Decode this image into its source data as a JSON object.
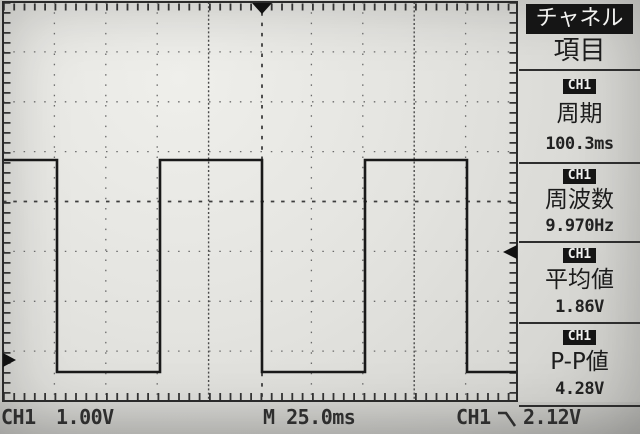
{
  "device": "oscilloscope-screen",
  "sidebar": {
    "title": "チャネル",
    "subtitle": "項目",
    "measurements": [
      {
        "channel": "CH1",
        "label": "周期",
        "value": "100.3ms"
      },
      {
        "channel": "CH1",
        "label": "周波数",
        "value": "9.970Hz"
      },
      {
        "channel": "CH1",
        "label": "平均値",
        "value": "1.86V"
      },
      {
        "channel": "CH1",
        "label": "P-P値",
        "value": "4.28V"
      }
    ]
  },
  "status_bar": {
    "ch1_label": "CH1",
    "ch1_scale": "1.00V",
    "timebase": "M 25.0ms",
    "trigger_source": "CH1",
    "trigger_edge_icon": "falling-edge-icon",
    "trigger_level": "2.12V"
  },
  "display": {
    "divisions": {
      "horizontal": 10,
      "vertical": 8
    },
    "waveform": {
      "channel": "CH1",
      "shape": "square",
      "volts_per_div": "1.00V",
      "time_per_div": "25.0ms",
      "period": "100.3ms",
      "frequency": "9.970Hz",
      "mean": "1.86V",
      "peak_to_peak": "4.28V",
      "points": [
        [
          4,
          160
        ],
        [
          57,
          160
        ],
        [
          57,
          372
        ],
        [
          160,
          372
        ],
        [
          160,
          160
        ],
        [
          262,
          160
        ],
        [
          262,
          372
        ],
        [
          365,
          372
        ],
        [
          365,
          160
        ],
        [
          467,
          160
        ],
        [
          467,
          372
        ],
        [
          516,
          372
        ]
      ]
    },
    "markers": {
      "trigger_position_x": 262,
      "trigger_level_y": 252,
      "trigger_level_value": "2.12V",
      "ch1_ground_y": 360
    }
  },
  "colors": {
    "screen_bg": "#e3e3df",
    "ink": "#1c1c1c",
    "grid_dots": "#6a6a6a",
    "inverted_bg": "#151515",
    "inverted_fg": "#f2f2f0"
  }
}
